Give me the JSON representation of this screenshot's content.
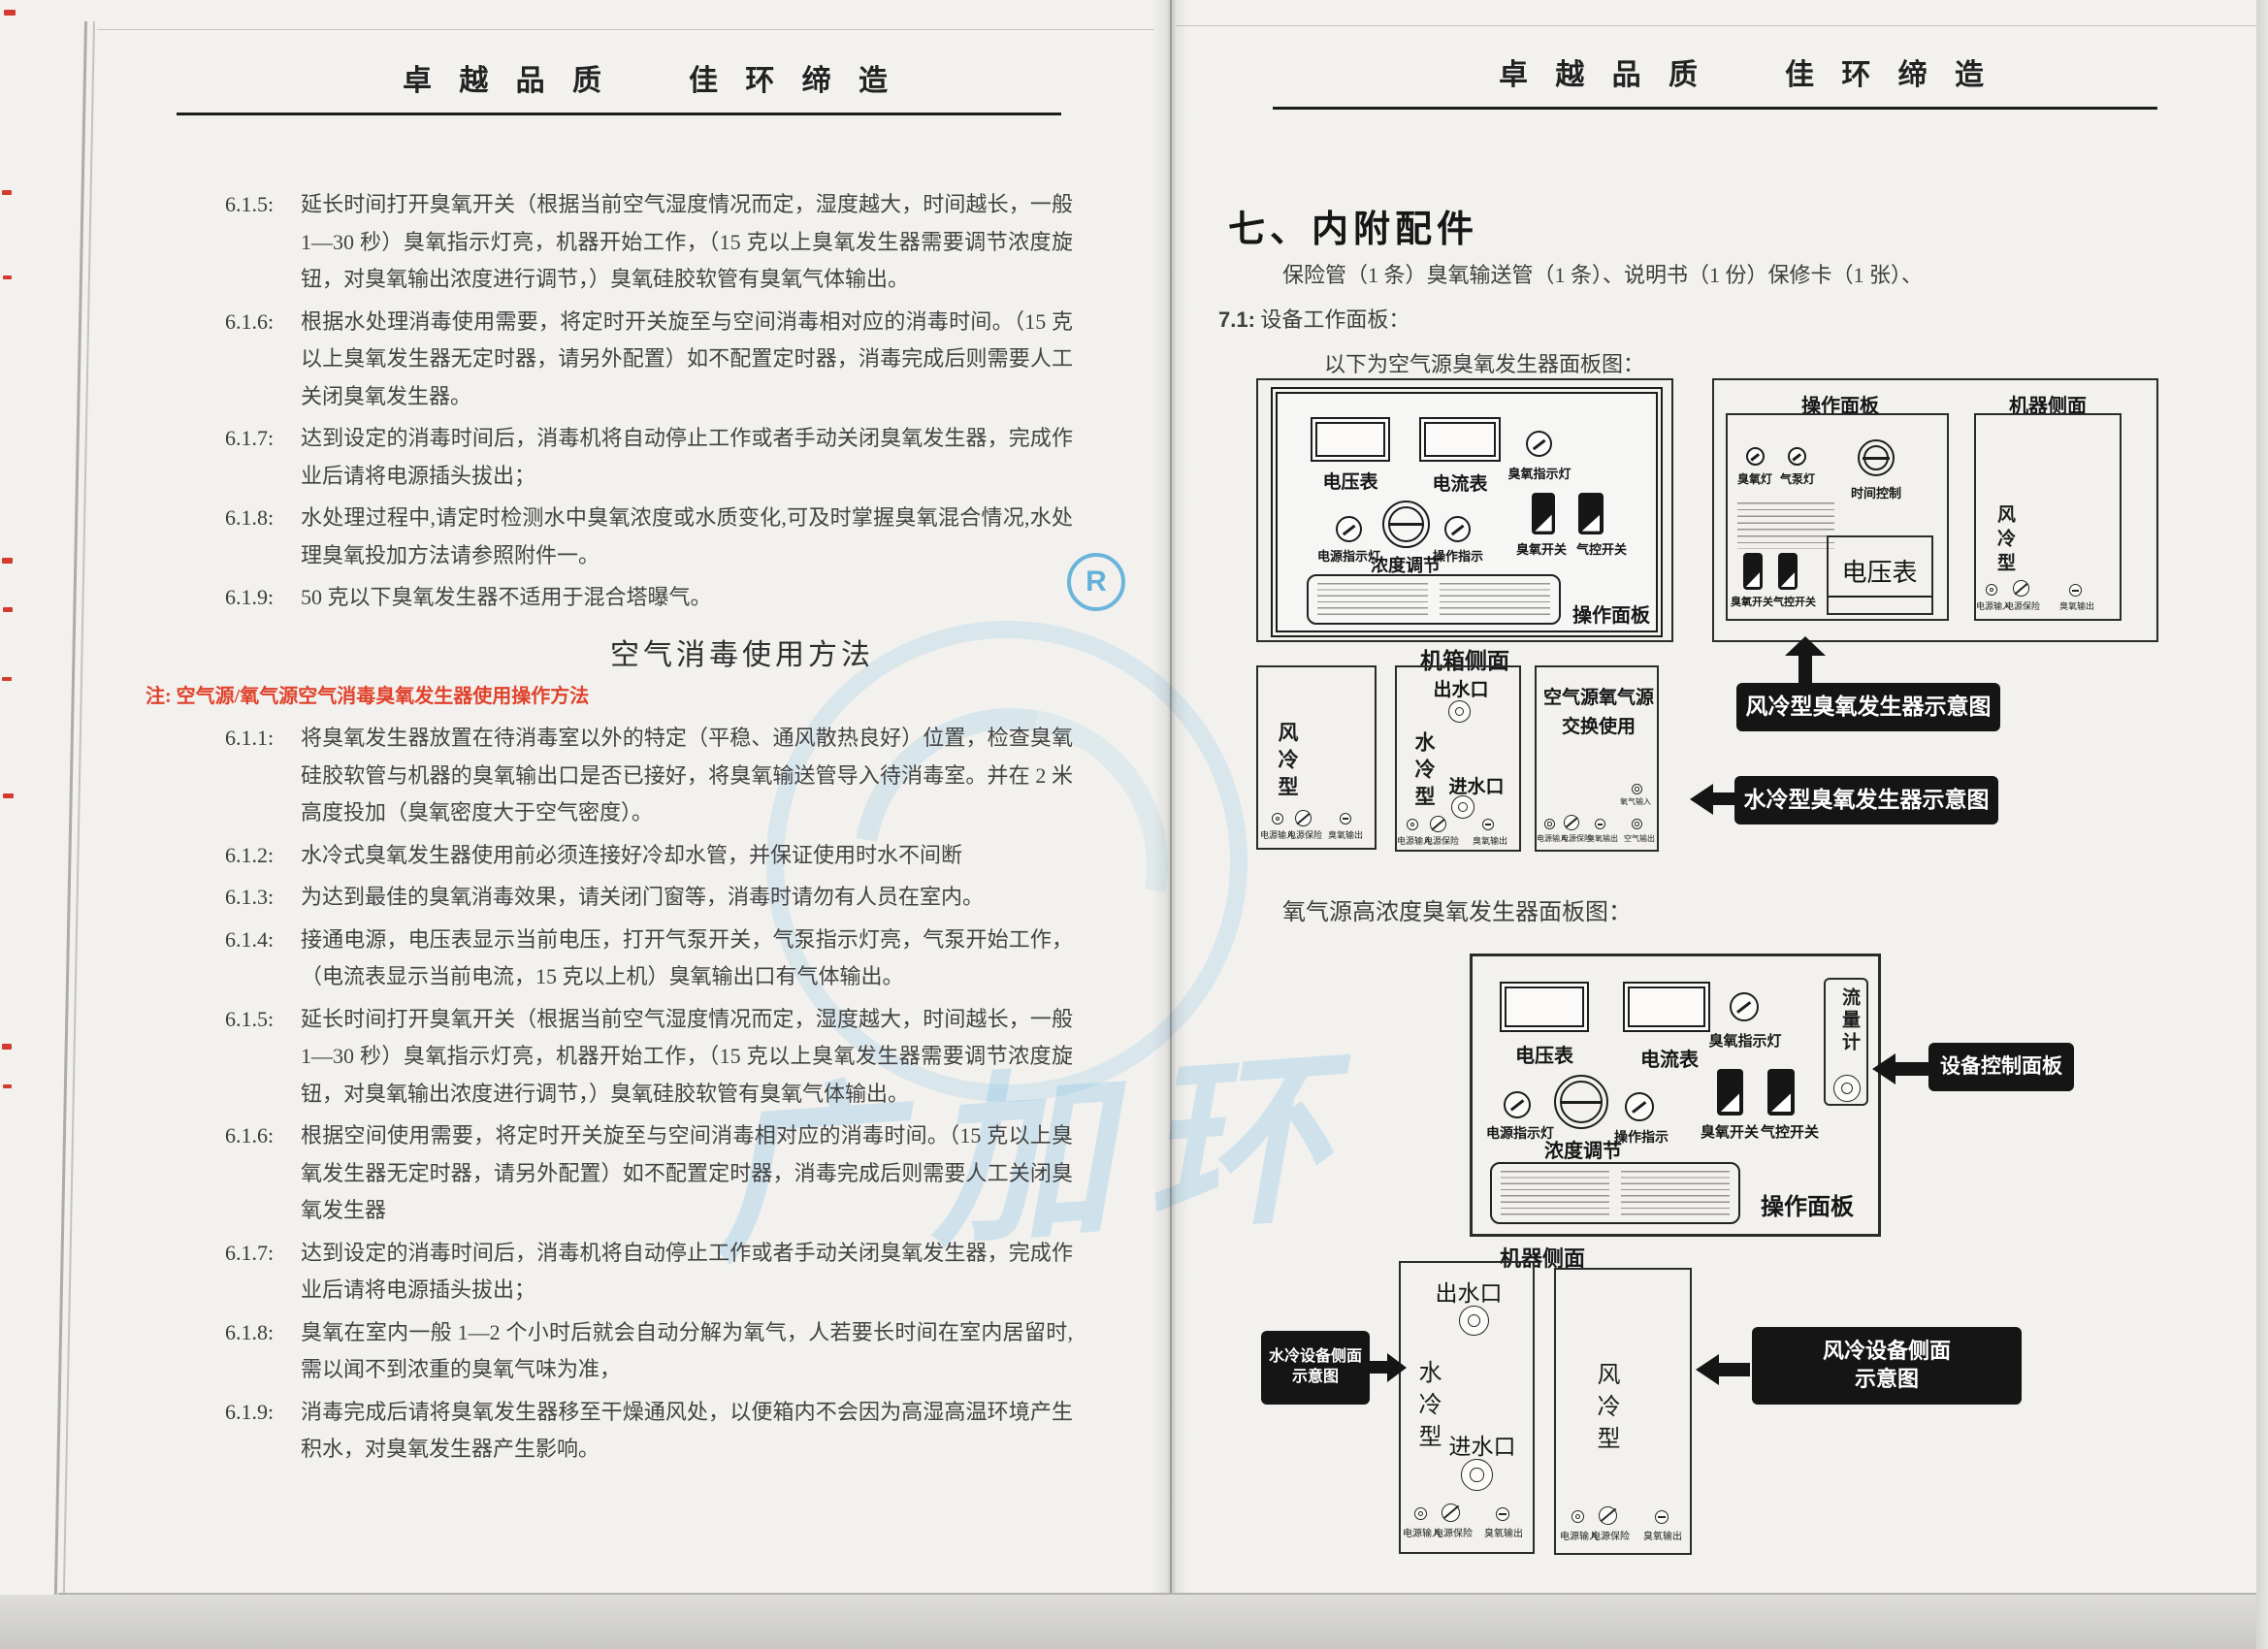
{
  "motto": "卓 越 品 质　　佳 环 缔 造",
  "colors": {
    "note_red": "#e0422b",
    "callout_bg": "#151515",
    "watermark_blue": "#76bce6"
  },
  "left_page": {
    "top_items": [
      {
        "num": "6.1.5:",
        "text": "延长时间打开臭氧开关（根据当前空气湿度情况而定，湿度越大，时间越长，一般 1—30 秒）臭氧指示灯亮，机器开始工作，（15 克以上臭氧发生器需要调节浓度旋钮，对臭氧输出浓度进行调节，）臭氧硅胶软管有臭氧气体输出。"
      },
      {
        "num": "6.1.6:",
        "text": "根据水处理消毒使用需要，将定时开关旋至与空间消毒相对应的消毒时间。（15 克以上臭氧发生器无定时器，请另外配置）如不配置定时器，消毒完成后则需要人工关闭臭氧发生器。"
      },
      {
        "num": "6.1.7:",
        "text": "达到设定的消毒时间后，消毒机将自动停止工作或者手动关闭臭氧发生器，完成作业后请将电源插头拔出；"
      },
      {
        "num": "6.1.8:",
        "text": "水处理过程中,请定时检测水中臭氧浓度或水质变化,可及时掌握臭氧混合情况,水处理臭氧投加方法请参照附件一。"
      },
      {
        "num": "6.1.9:",
        "text": "50 克以下臭氧发生器不适用于混合塔曝气。"
      }
    ],
    "air_title": "空气消毒使用方法",
    "registered": "R",
    "watermark_text": "广加环",
    "air_note": "注: 空气源/氧气源空气消毒臭氧发生器使用操作方法",
    "air_items": [
      {
        "num": "6.1.1:",
        "text": "将臭氧发生器放置在待消毒室以外的特定（平稳、通风散热良好）位置，检查臭氧硅胶软管与机器的臭氧输出口是否已接好，将臭氧输送管导入待消毒室。并在 2 米高度投加（臭氧密度大于空气密度）。"
      },
      {
        "num": "6.1.2:",
        "text": "水冷式臭氧发生器使用前必须连接好冷却水管，并保证使用时水不间断"
      },
      {
        "num": "6.1.3:",
        "text": "为达到最佳的臭氧消毒效果，请关闭门窗等，消毒时请勿有人员在室内。"
      },
      {
        "num": "6.1.4:",
        "text": "接通电源，电压表显示当前电压，打开气泵开关，气泵指示灯亮，气泵开始工作，（电流表显示当前电流，15 克以上机）臭氧输出口有气体输出。"
      },
      {
        "num": "6.1.5:",
        "text": "延长时间打开臭氧开关（根据当前空气湿度情况而定，湿度越大，时间越长，一般 1—30 秒）臭氧指示灯亮，机器开始工作，（15 克以上臭氧发生器需要调节浓度旋钮，对臭氧输出浓度进行调节，）臭氧硅胶软管有臭氧气体输出。"
      },
      {
        "num": "6.1.6:",
        "text": "根据空间使用需要，将定时开关旋至与空间消毒相对应的消毒时间。（15 克以上臭氧发生器无定时器，请另外配置）如不配置定时器，消毒完成后则需要人工关闭臭氧发生器"
      },
      {
        "num": "6.1.7:",
        "text": "达到设定的消毒时间后，消毒机将自动停止工作或者手动关闭臭氧发生器，完成作业后请将电源插头拔出；"
      },
      {
        "num": "6.1.8:",
        "text": "臭氧在室内一般 1—2 个小时后就会自动分解为氧气，人若要长时间在室内居留时,需以闻不到浓重的臭氧气味为准，"
      },
      {
        "num": "6.1.9:",
        "text": "消毒完成后请将臭氧发生器移至干燥通风处，以便箱内不会因为高湿高温环境产生积水，对臭氧发生器产生影响。"
      }
    ]
  },
  "right_page": {
    "section_title": "七、内附配件",
    "accessories": "保险管（1 条）臭氧输送管（1 条）、说明书（1 份）保修卡（1 张）、",
    "s71_num": "7.1:",
    "s71_label": "设备工作面板：",
    "fig1_intro": "以下为空气源臭氧发生器面板图：",
    "fig2_intro": "氧气源高浓度臭氧发生器面板图：",
    "labels": {
      "voltmeter": "电压表",
      "ammeter": "电流表",
      "ozone_lamp": "臭氧指示灯",
      "power_lamp": "电源指示灯",
      "concentration": "浓度调节",
      "op_lamp": "操作指示",
      "ozone_switch": "臭氧开关",
      "air_switch": "气控开关",
      "op_panel": "操作面板",
      "chassis_side": "机箱侧面",
      "machine_side": "机器侧面",
      "air_cooled": "风冷型",
      "water_cooled": "水冷型",
      "swap1": "空气源氧气源",
      "swap2": "交换使用",
      "water_out": "出水口",
      "water_in": "进水口",
      "power_in": "电源输入",
      "power_fuse": "电源保险",
      "ozone_out": "臭氧输出",
      "air_out": "空气输出",
      "oxygen_in": "氧气输入",
      "ozone_light": "臭氧灯",
      "pump_light": "气泵灯",
      "time_ctrl": "时间控制",
      "flow_meter": "流量计"
    },
    "callouts": {
      "fan_gen": "风冷型臭氧发生器示意图",
      "water_gen": "水冷型臭氧发生器示意图",
      "device_panel": "设备控制面板",
      "water_side1": "水冷设备侧面",
      "water_side2": "示意图",
      "fan_side1": "风冷设备侧面",
      "fan_side2": "示意图"
    }
  }
}
